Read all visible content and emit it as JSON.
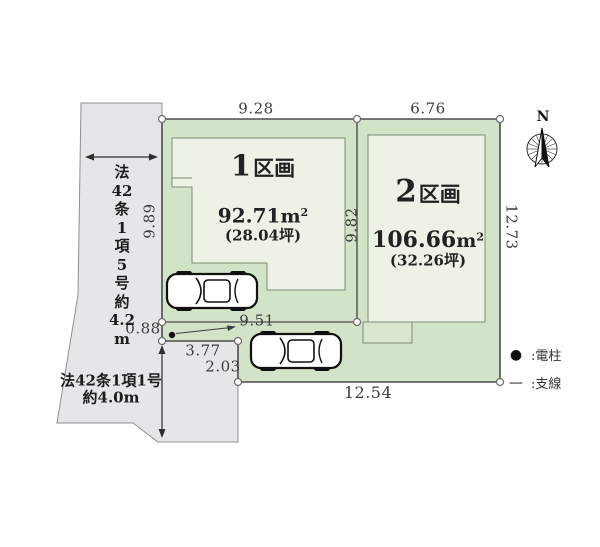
{
  "compass": {
    "north_label": "N"
  },
  "plots": [
    {
      "number": "1",
      "suffix": "区画",
      "area_value": "92.71",
      "area_unit": "m",
      "area_sup": "2",
      "tsubo": "(28.04坪)"
    },
    {
      "number": "2",
      "suffix": "区画",
      "area_value": "106.66",
      "area_unit": "m",
      "area_sup": "2",
      "tsubo": "(32.26坪)"
    }
  ],
  "dimensions": {
    "plot1_top": "9.28",
    "plot2_top": "6.76",
    "left": "9.89",
    "divider": "9.82",
    "right": "12.73",
    "plot1_bottom": "9.51",
    "left_lower": "0.88",
    "notch_width": "3.77",
    "notch_height": "2.03",
    "bottom": "12.54"
  },
  "roads": {
    "left": {
      "full_text": "法42条1項5号 約4.2m",
      "lines": [
        "法",
        "42",
        "条",
        "1",
        "項",
        "5",
        "号",
        "約",
        "4.2",
        "m"
      ]
    },
    "bottom": {
      "line1": "法42条1項1号",
      "line2": "約4.0m"
    }
  },
  "legend": {
    "items": [
      {
        "symbol": "●",
        "label": ":電柱"
      },
      {
        "symbol": "—",
        "label": ":支線"
      }
    ]
  },
  "colors": {
    "plot_fill": "#d3e3c7",
    "building_fill": "#edf2e6",
    "road_fill": "#e6e6e9",
    "boundary_line": "#4d4d4d"
  }
}
